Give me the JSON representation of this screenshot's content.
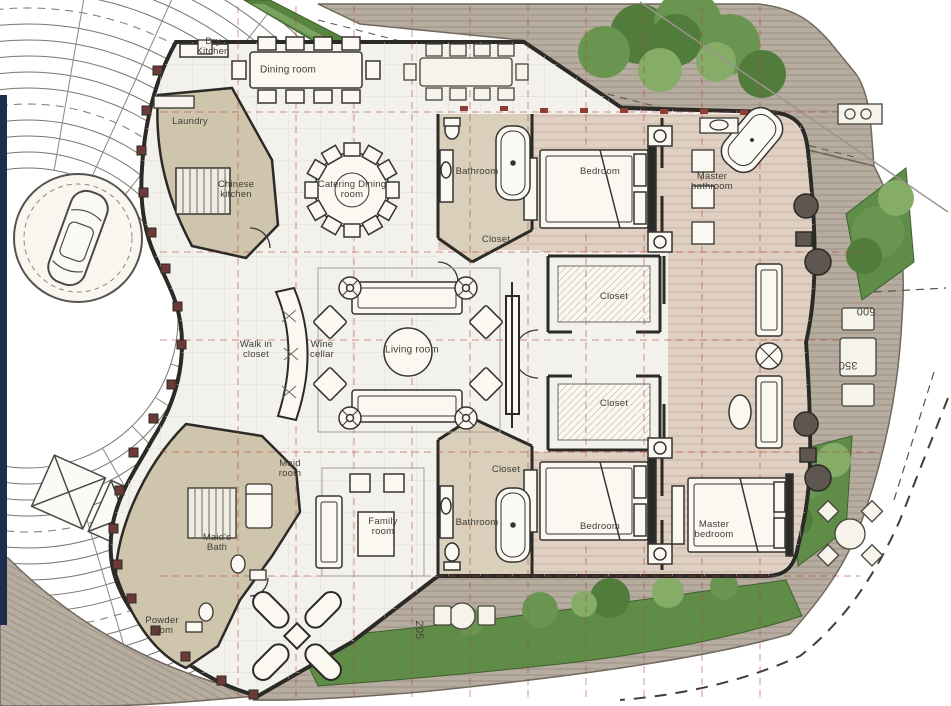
{
  "plan": {
    "type": "residential-floor-plan",
    "colors": {
      "wall": "#2b2a26",
      "marble_floor": "#f3f1ec",
      "service_beige": "#cfc5ad",
      "bedroom_wood": "#dfd0c3",
      "deck_wood": "#b6ac9f",
      "landscape_green": "#5f8c47",
      "grid_red": "#b33d36",
      "edge_navy": "#1e2c4e"
    }
  },
  "rooms": {
    "dry_kitchen": "Dry\nKitchen",
    "dining_room": "Dining room",
    "laundry": "Laundry",
    "chinese_kitchen": "Chinese\nkitchen",
    "catering_dining": "Catering Dining\nroom",
    "walk_in_closet": "Walk in\ncloset",
    "wine_cellar": "Wine\ncellar",
    "living_room": "Living room",
    "bathroom_top": "Bathroom",
    "bedroom_top": "Bedroom",
    "master_bathroom": "Master\nbathroom",
    "closet_top": "Closet",
    "closet_mid_upper": "Closet",
    "closet_mid_lower": "Closet",
    "closet_bottom": "Closet",
    "bathroom_bottom": "Bathroom",
    "bedroom_bottom": "Bedroom",
    "master_bedroom": "Master\nbedroom",
    "family_room": "Family\nroom",
    "maid_room": "Maid\nroom",
    "maids_bath": "Maid's\nBath",
    "powder_room": "Powder\nroom"
  },
  "dimensions": {
    "d500": "500",
    "d350": "350",
    "d205": "205"
  }
}
